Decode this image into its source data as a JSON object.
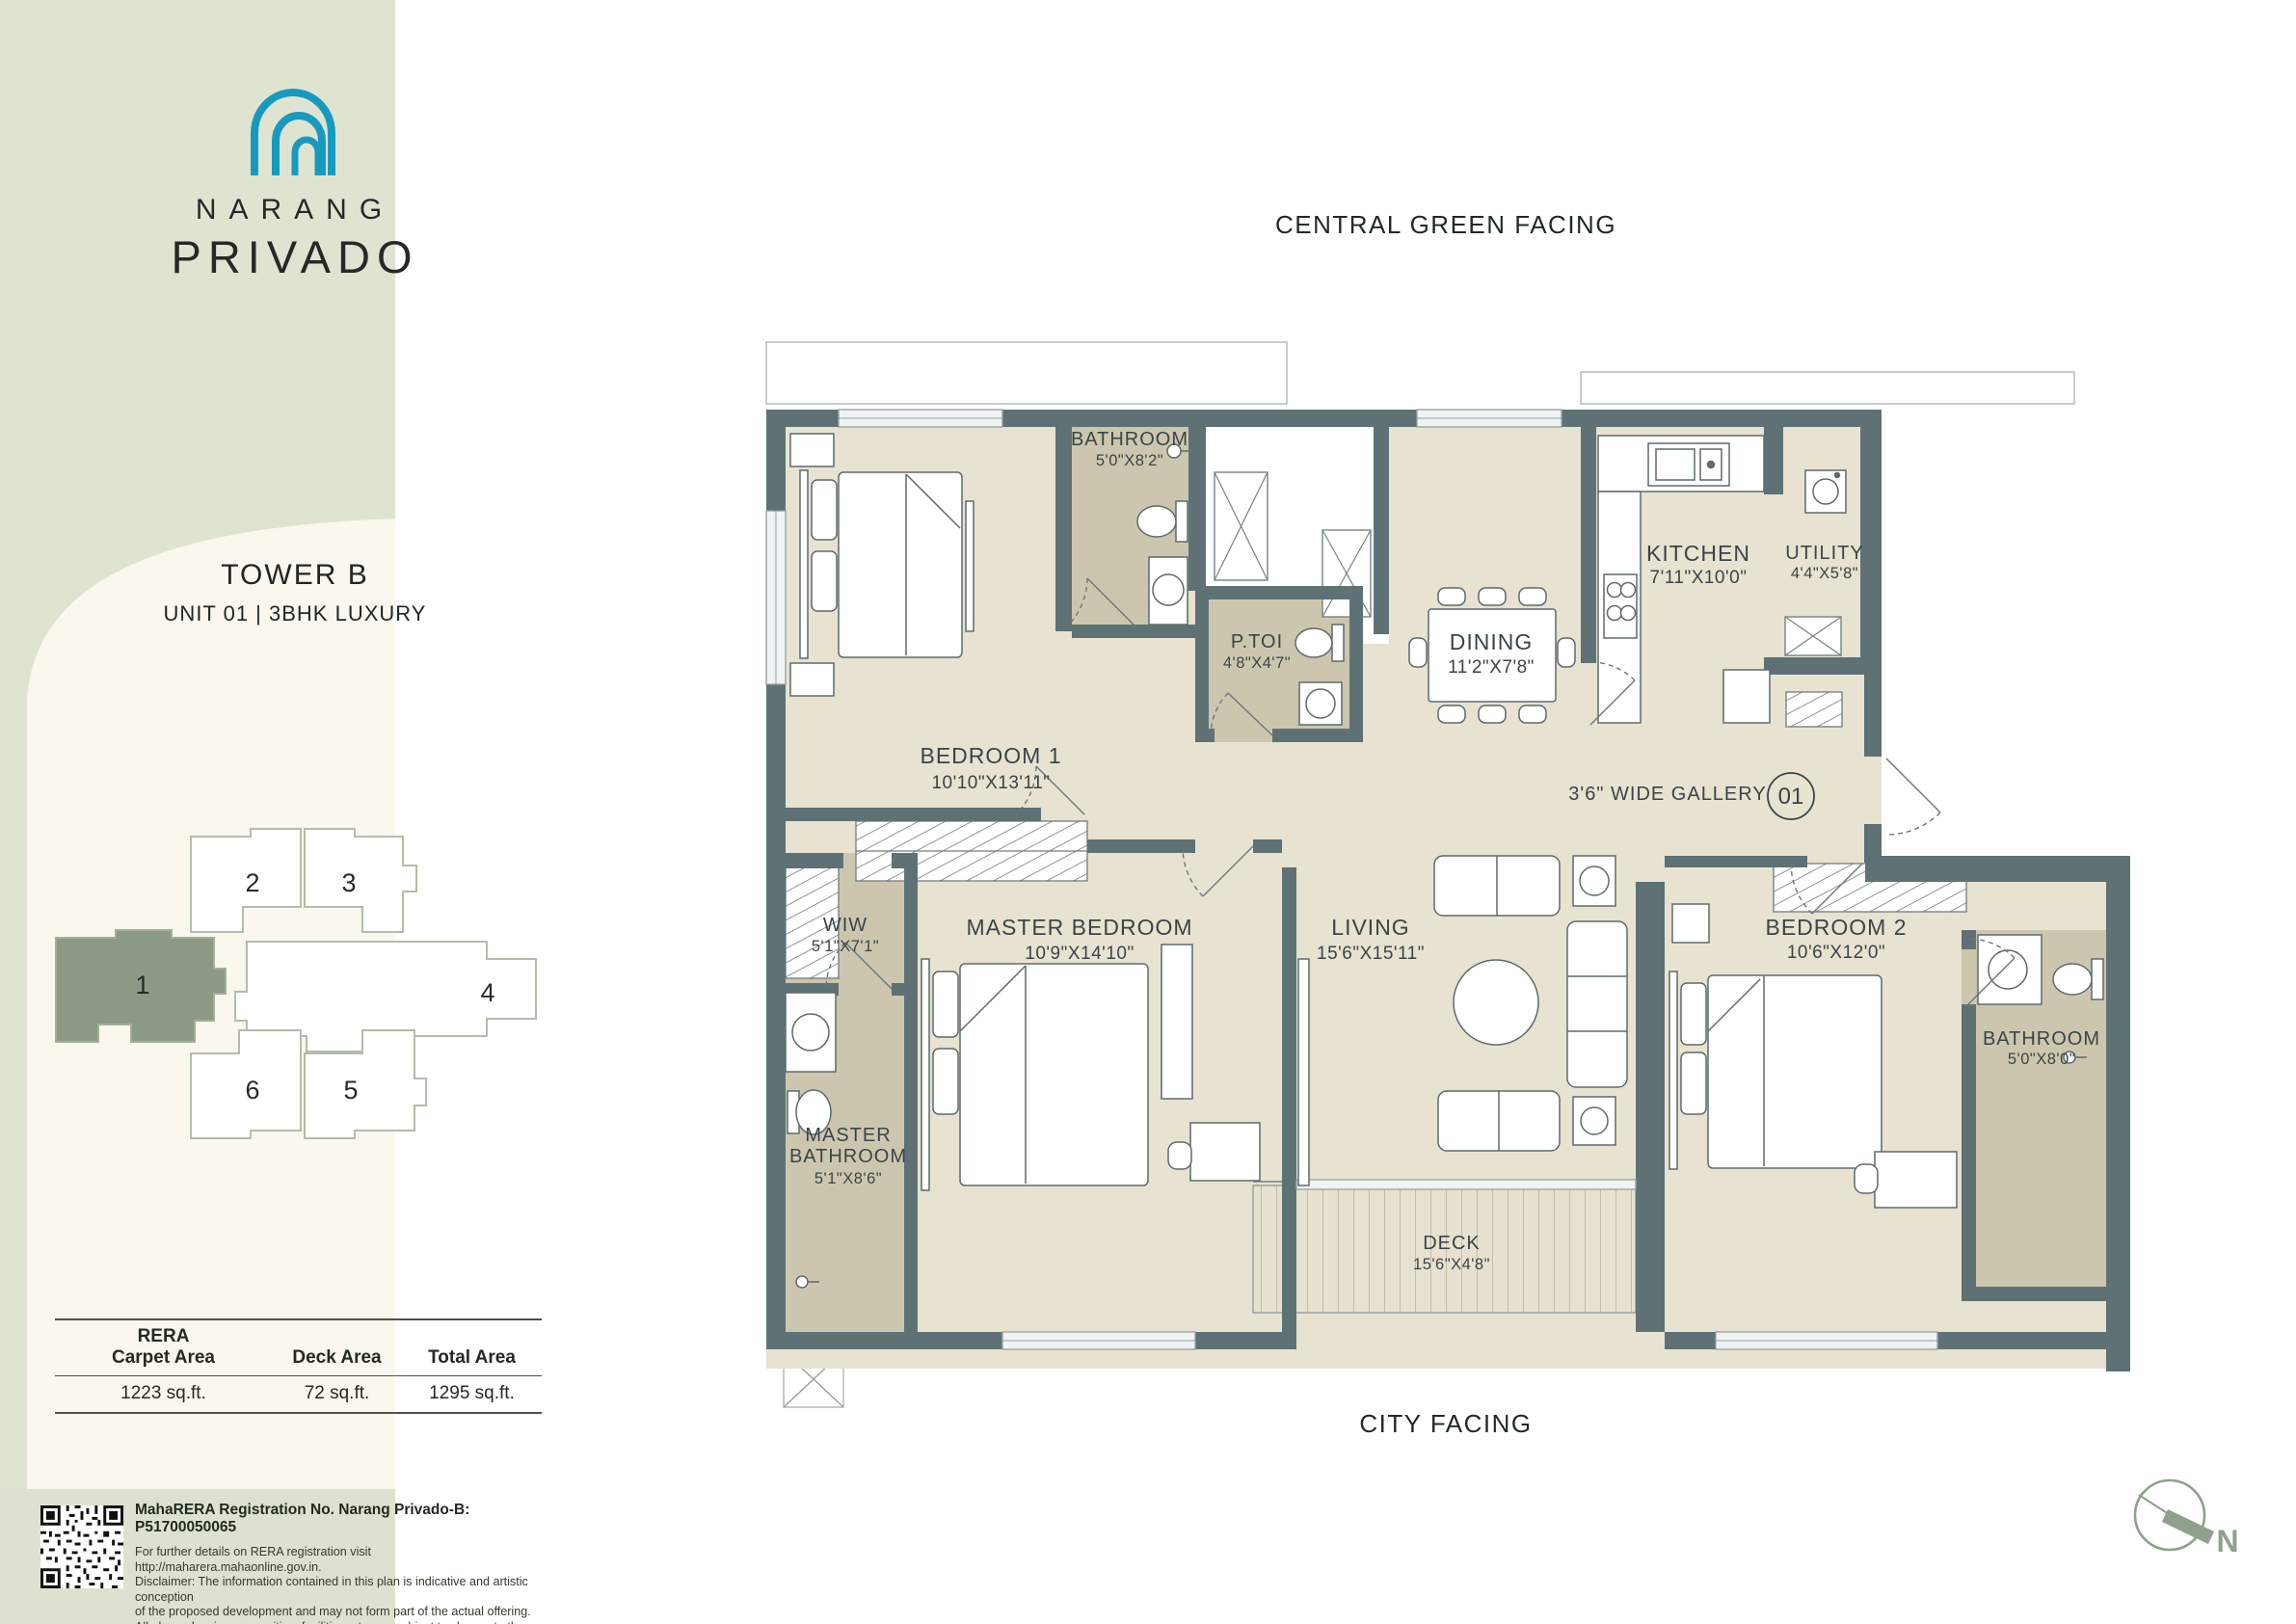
{
  "brand": {
    "line1": "NARANG",
    "line2": "PRIVADO"
  },
  "unit_info": {
    "tower": "TOWER B",
    "subtitle": "UNIT 01  |  3BHK LUXURY"
  },
  "facing": {
    "top": "CENTRAL GREEN FACING",
    "bottom": "CITY FACING"
  },
  "unit_badge": "01",
  "gallery_label": "3'6\" WIDE GALLERY",
  "compass_label": "N",
  "keyplan": {
    "highlighted_unit": "1",
    "units": [
      "1",
      "2",
      "3",
      "4",
      "5",
      "6"
    ]
  },
  "rooms": {
    "bedroom1": {
      "name": "BEDROOM 1",
      "dims": "10'10\"X13'11\""
    },
    "bathroom1": {
      "name": "BATHROOM",
      "dims": "5'0\"X8'2\""
    },
    "ptoi": {
      "name": "P.TOI",
      "dims": "4'8\"X4'7\""
    },
    "dining": {
      "name": "DINING",
      "dims": "11'2\"X7'8\""
    },
    "kitchen": {
      "name": "KITCHEN",
      "dims": "7'11\"X10'0\""
    },
    "utility": {
      "name": "UTILITY",
      "dims": "4'4\"X5'8\""
    },
    "wiw": {
      "name": "WIW",
      "dims": "5'1\"X7'1\""
    },
    "master_bedroom": {
      "name": "MASTER BEDROOM",
      "dims": "10'9\"X14'10\""
    },
    "master_bathroom": {
      "name_line1": "MASTER",
      "name_line2": "BATHROOM",
      "dims": "5'1\"X8'6\""
    },
    "living": {
      "name": "LIVING",
      "dims": "15'6\"X15'11\""
    },
    "bedroom2": {
      "name": "BEDROOM 2",
      "dims": "10'6\"X12'0\""
    },
    "bathroom2": {
      "name": "BATHROOM",
      "dims": "5'0\"X8'0\""
    },
    "deck": {
      "name": "DECK",
      "dims": "15'6\"X4'8\""
    }
  },
  "area_table": {
    "columns": [
      {
        "h1": "RERA",
        "h2": "Carpet Area",
        "value": "1223 sq.ft."
      },
      {
        "h1": "",
        "h2": "Deck Area",
        "value": "72 sq.ft."
      },
      {
        "h1": "",
        "h2": "Total Area",
        "value": "1295 sq.ft."
      }
    ]
  },
  "legal": {
    "registration": "MahaRERA Registration No. Narang Privado-B: P51700050065",
    "lines": [
      "For further details on RERA registration visit http://maharera.mahaonline.gov.in.",
      "Disclaimer: The information contained in this plan is indicative and artistic conception",
      "of the proposed development and may not form part of the actual offering.",
      "All plans, drawings, amenities, facilities, etc. are subject to change to the approval",
      "of the concerned authorities and the developer reserves the right to amend the same",
      "at any time without notice."
    ]
  },
  "colors": {
    "logo_teal": "#189ABF",
    "sidebar_green": "#DFE4D1",
    "arch_cream": "#F9F7EE",
    "keyplan_highlight": "#8C9A85",
    "wall": "#5E7276",
    "floor_beige": "#E8E2D0",
    "floor_taupe": "#CDC6AE",
    "compass_green": "#8FA08C"
  }
}
